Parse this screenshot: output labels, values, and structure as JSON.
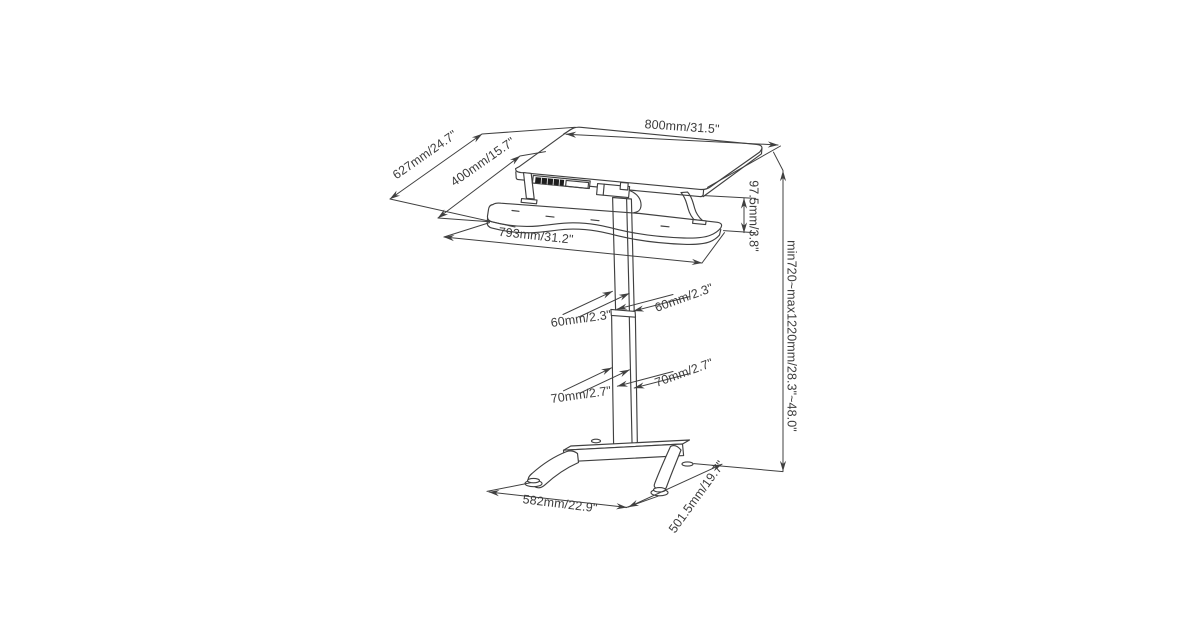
{
  "figure": {
    "subject": "Height-adjustable sit-stand desk with keyboard tray — dimensional technical line drawing",
    "view": "isometric wireframe",
    "background_color": "#ffffff",
    "line_color": "#404040",
    "text_color": "#3c3c3c"
  },
  "dimensions": {
    "top_width": "800mm/31.5\"",
    "total_depth": "627mm/24.7\"",
    "top_depth": "400mm/15.7\"",
    "tray_width": "793mm/31.2\"",
    "top_to_tray_height": "97.5mm/3.8\"",
    "height_range": "min720~max1220mm/28.3\"~48.0\"",
    "upper_column_front": "60mm/2.3\"",
    "upper_column_side": "60mm/2.3\"",
    "lower_column_front": "70mm/2.7\"",
    "lower_column_side": "70mm/2.7\"",
    "base_width": "582mm/22.9\"",
    "base_depth": "501.5mm/19.7\""
  }
}
